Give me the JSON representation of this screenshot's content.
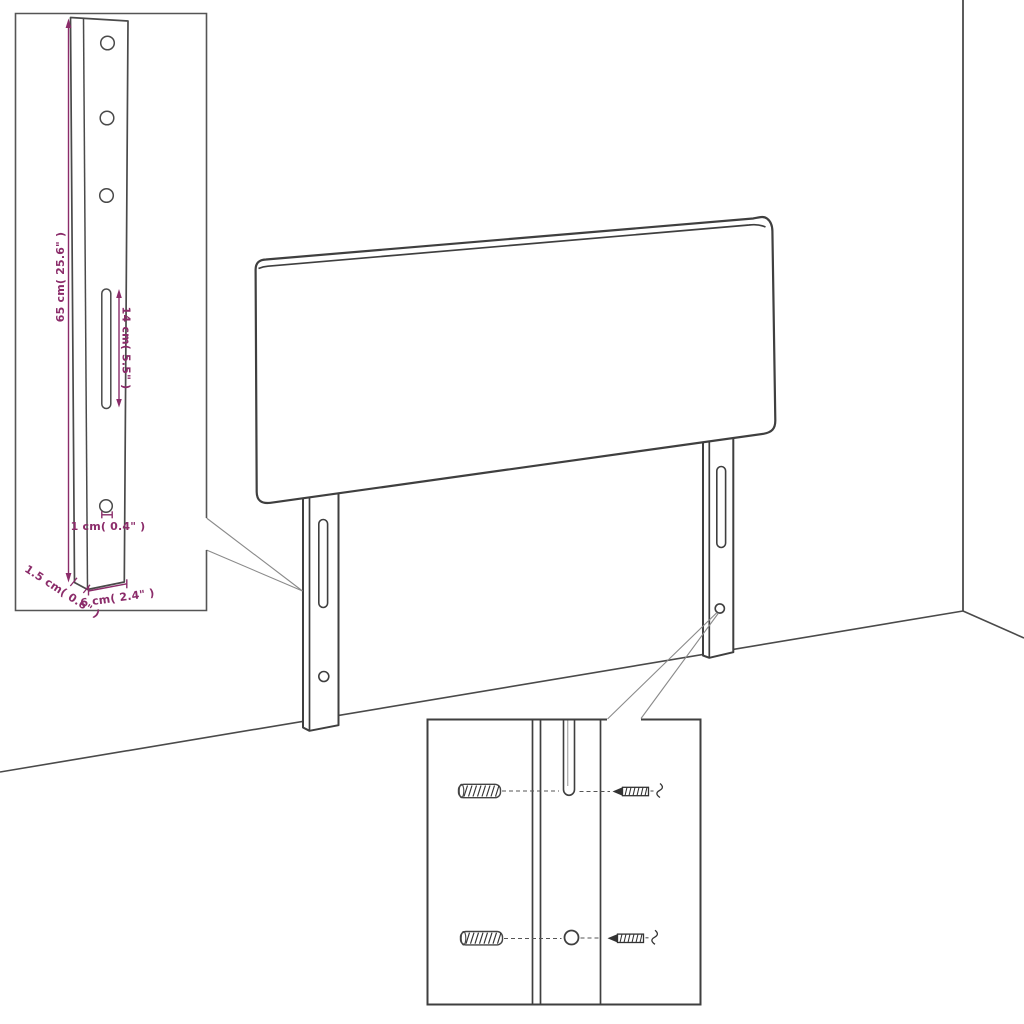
{
  "diagram": {
    "title": "headboard-assembly-dimension-diagram",
    "colors": {
      "outline": "#3f3f3f",
      "inset_line": "#4a4a4a",
      "dimension_accent": "#8b2c6a",
      "leader": "#8a8a8a",
      "background": "#ffffff"
    },
    "dims": {
      "height": "65 cm( 25.6\" )",
      "slot": "14 cm( 5.5\" )",
      "hole": "1 cm( 0.4\" )",
      "thickness": "1.5 cm( 0.6\" )",
      "width": "6 cm( 2.4\" )"
    }
  }
}
